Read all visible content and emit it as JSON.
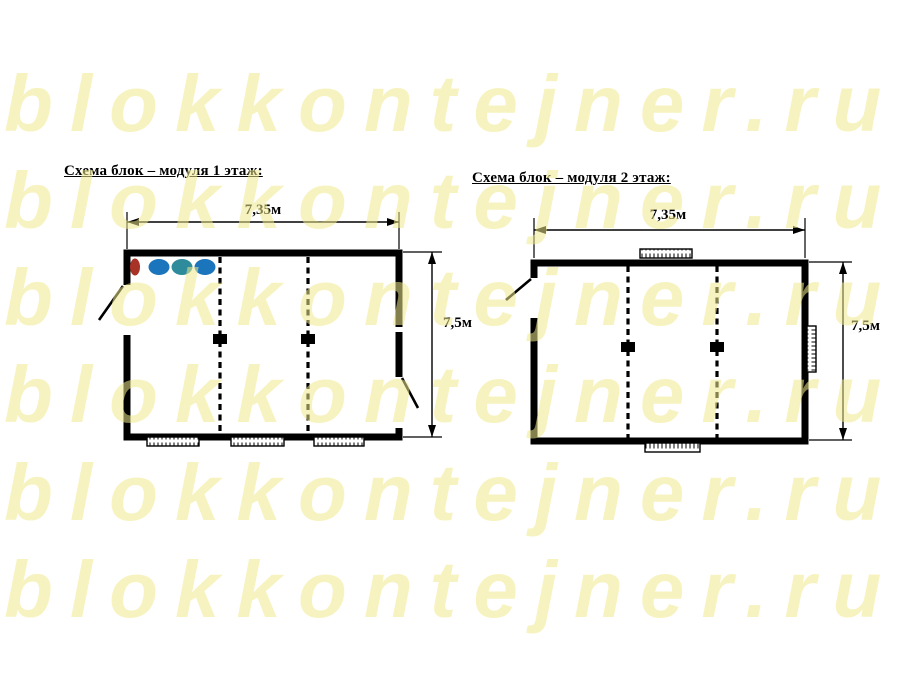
{
  "page": {
    "background_color": "#ffffff",
    "ink_color": "#000000"
  },
  "watermark": {
    "text": "blokkontejner.ru",
    "color": "#f0e98c",
    "row_count": 6
  },
  "floor1": {
    "title": "Схема блок – модуля 1 этаж:",
    "width_label": "7,35м",
    "height_label": "7,5м"
  },
  "floor2": {
    "title": "Схема блок – модуля 2 этаж:",
    "width_label": "7,35м",
    "height_label": "7,5м"
  },
  "fixtures": {
    "red": "#a93226",
    "blue": "#1b75bc",
    "teal": "#2e8b9c"
  }
}
